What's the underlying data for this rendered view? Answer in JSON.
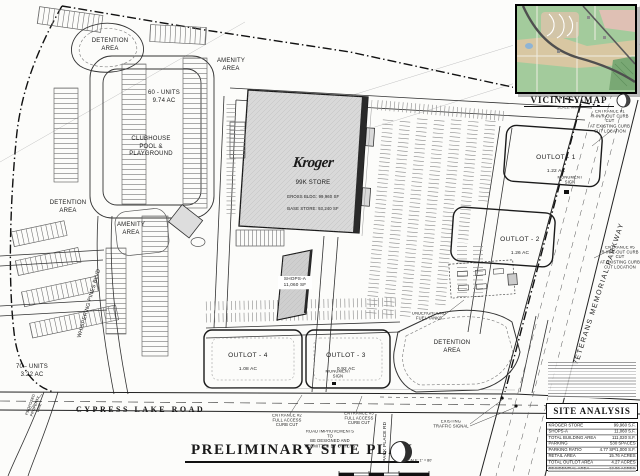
{
  "title_block": {
    "title": "PRELIMINARY SITE PLAN",
    "scale_label": "SCALE: 1\" = 80'"
  },
  "vicinity_map": {
    "title": "VICINITY MAP",
    "scale_label": "SCALE: N.T.S."
  },
  "site_analysis": {
    "title": "SITE ANALYSIS",
    "rows": [
      {
        "label": "KROGER STORE",
        "value": "99,960 S.F."
      },
      {
        "label": "SHOPS-A",
        "value": "11,060 S.F."
      },
      {
        "label": "TOTAL BUILDING AREA",
        "value": "111,020 S.F."
      },
      {
        "label": "PARKING",
        "value": "530 SPACES"
      },
      {
        "label": "PARKING RATIO",
        "value": "4.77 SP/1,000 S.F."
      },
      {
        "label": "RETAIL AREA",
        "value": "15.76 ACRES"
      },
      {
        "label": "TOTAL OUTLOT AREA",
        "value": "4.27 ACRES"
      },
      {
        "label": "RESIDENTIAL AREA",
        "value": "12.96 ACRES"
      },
      {
        "label": "TOTAL SITE AREA",
        "value": "32.94 ACRES"
      }
    ]
  },
  "buildings": {
    "kroger_logo": "Kroger",
    "kroger_line1": "99K STORE",
    "kroger_line2": "GROSS BLDG: 99,960 SF",
    "kroger_line3": "BASE STORE: 93,240 SF",
    "shops_a": "SHOPS-A\n11,060 SF"
  },
  "outlots": [
    {
      "name": "OUTLOT - 1",
      "area": "1.22 AC"
    },
    {
      "name": "OUTLOT - 2",
      "area": "1.26 AC"
    },
    {
      "name": "OUTLOT - 3",
      "area": "0.92 AC"
    },
    {
      "name": "OUTLOT - 4",
      "area": "1.08 AC"
    }
  ],
  "areas": {
    "detention_nw": "DETENTION\nAREA",
    "amenity_n": "AMENITY\nAREA",
    "units_60": "60 - UNITS\n9.74 AC",
    "clubhouse": "CLUBHOUSE\nPOOL &\nPLAYGROUND",
    "detention_w": "DETENTION\nAREA",
    "amenity_w": "AMENITY\nAREA",
    "units_70": "70 - UNITS\n3.22 AC",
    "detention_se": "DETENTION\nAREA"
  },
  "roads": {
    "cypress": "CYPRESS LAKE ROAD",
    "veterans": "VETERANS MEMORIAL PARKWAY",
    "whispering": "WHISPERING PINES  BLVD",
    "park_place": "PARK PLACE RD"
  },
  "notes": {
    "entrance_1": "ENTRANCE #1\nR-IN/R-OUT CURB CUT\nAT EXISTING CURB\nCUT LOCATION",
    "entrance_5": "ENTRANCE #5\nR-IN/R-OUT CURB CUT\nAT EXISTING CURB\nCUT LOCATION",
    "entrance_2": "ENTRANCE #2\nFULL ACCESS\nCURB CUT",
    "entrance_3": "ENTRANCE #3\nFULL ACCESS\nCURB CUT",
    "road_improvements": "ROAD IMPROVEMENTS TO\nBE DESIGNED AND\nPERMITTED BY OTHERS",
    "traffic_signal": "EXISTING\nTRAFFIC SIGNAL",
    "fuel_tanks": "UNDERGROUND\nFUEL TANKS",
    "monument_sign_e": "MONUMENT\nSIGN",
    "monument_sign_s": "MONUMENT\nSIGN",
    "property_line": "PROPOSED\nPROPERTY LINE"
  },
  "colors": {
    "line": "#1a1a1a",
    "building_fill": "#d9d9d9",
    "map_green": "#a3cb9c",
    "map_tan": "#d8c7a2",
    "map_pink": "#dfc0b4"
  }
}
